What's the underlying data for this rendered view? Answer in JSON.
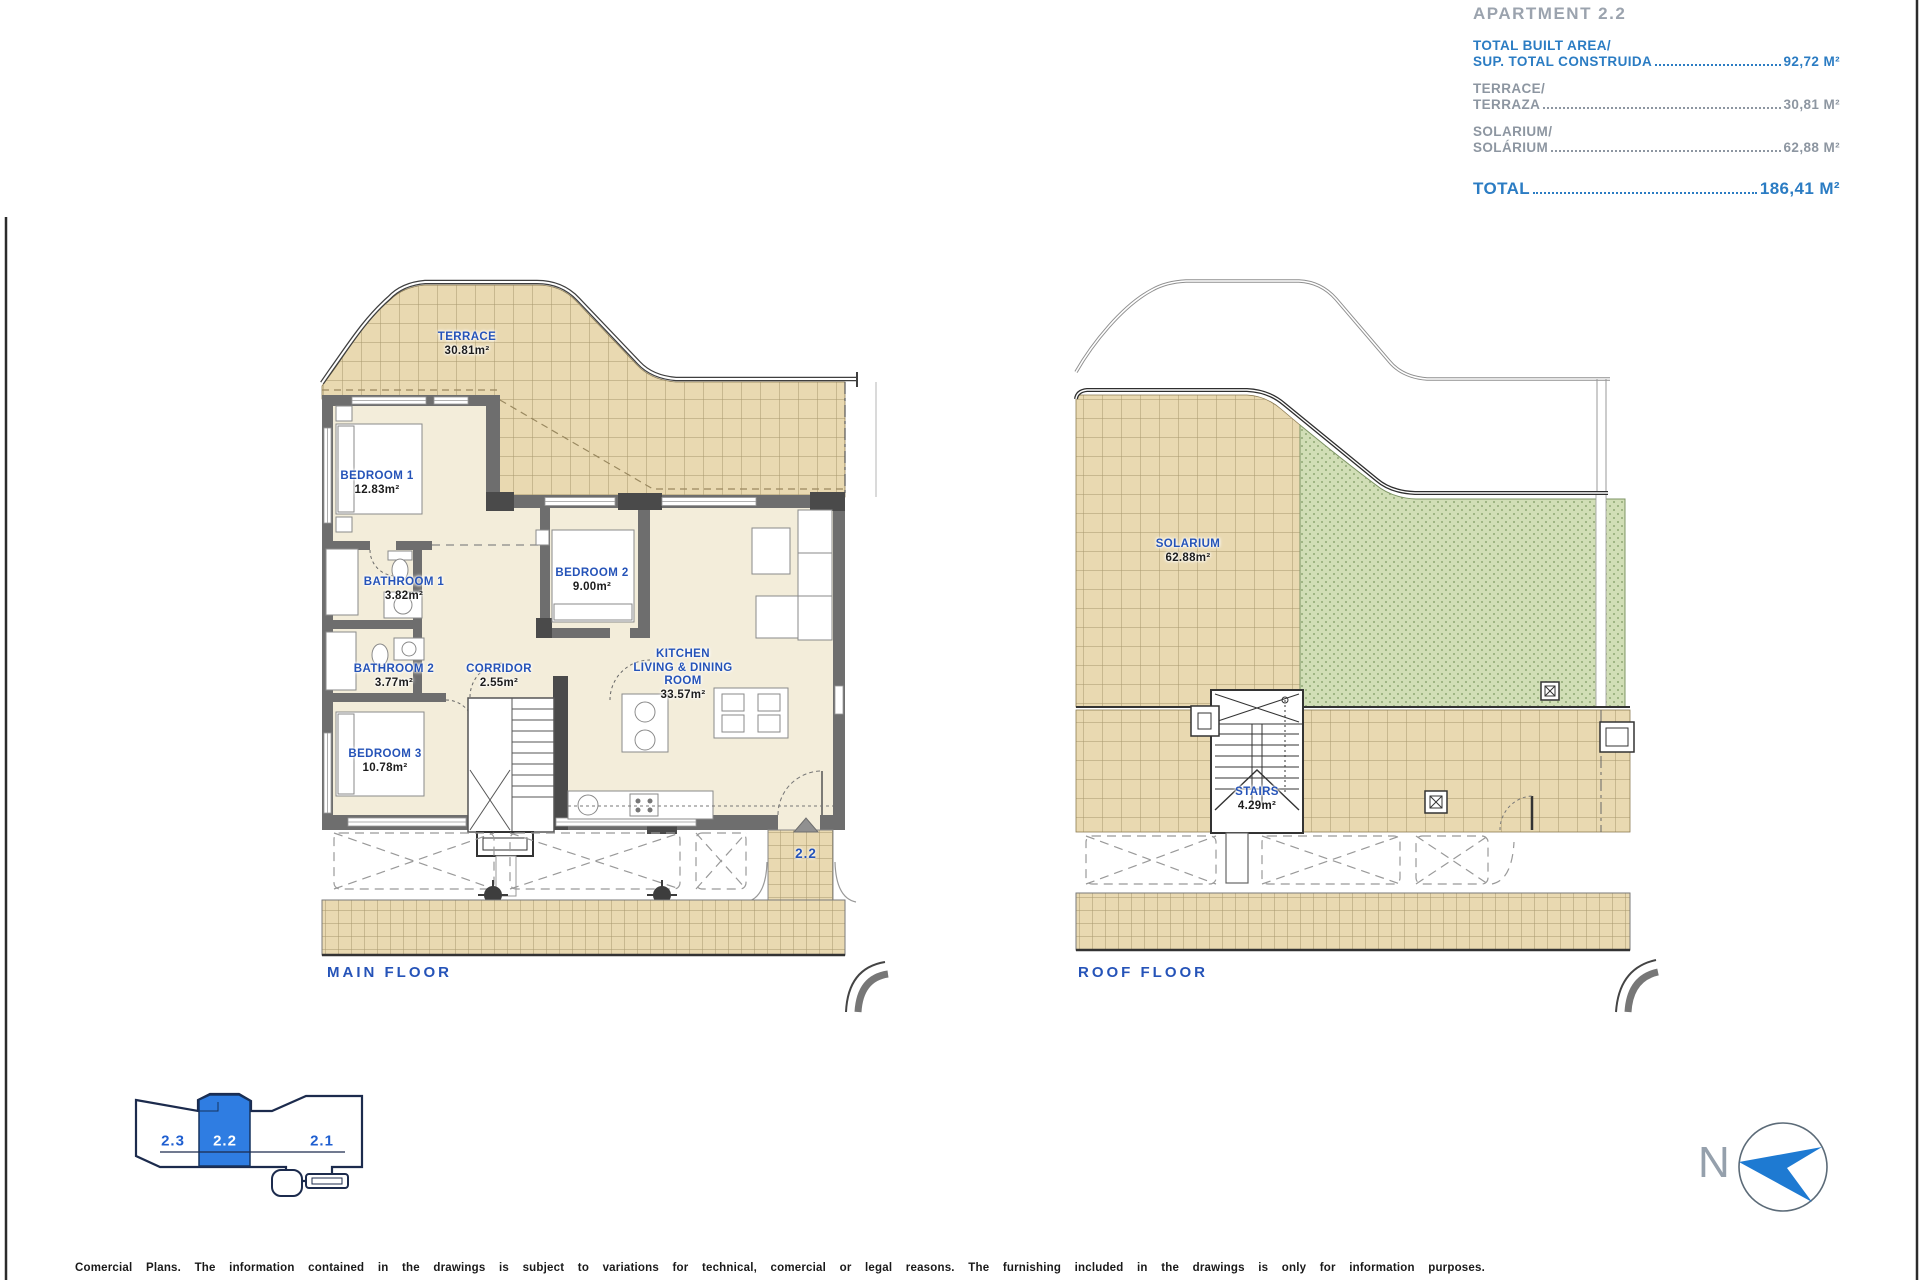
{
  "title_block": {
    "apartment_label": "APARTMENT 2.2",
    "rows": [
      {
        "label_line1": "TOTAL BUILT AREA/",
        "label_line2": "SUP. TOTAL CONSTRUIDA",
        "value": "92,72 M²",
        "emphasis": true
      },
      {
        "label_line1": "TERRACE/",
        "label_line2": "TERRAZA",
        "value": "30,81 M²",
        "emphasis": false
      },
      {
        "label_line1": "SOLARIUM/",
        "label_line2": "SOLÁRIUM",
        "value": "62,88 M²",
        "emphasis": false
      }
    ],
    "total_label": "TOTAL",
    "total_value": "186,41 M²"
  },
  "main_floor": {
    "caption": "MAIN FLOOR",
    "entrance_label": "2.2",
    "rooms": [
      {
        "name": "TERRACE",
        "area": "30.81m²"
      },
      {
        "name": "BEDROOM 1",
        "area": "12.83m²"
      },
      {
        "name": "BATHROOM 1",
        "area": "3.82m²"
      },
      {
        "name": "BATHROOM 2",
        "area": "3.77m²"
      },
      {
        "name": "CORRIDOR",
        "area": "2.55m²"
      },
      {
        "name": "BEDROOM 3",
        "area": "10.78m²"
      },
      {
        "name": "BEDROOM 2",
        "area": "9.00m²"
      },
      {
        "name_line1": "KITCHEN",
        "name_line2": "LIVING & DINING",
        "name_line3": "ROOM",
        "area": "33.57m²"
      }
    ]
  },
  "roof_floor": {
    "caption": "ROOF FLOOR",
    "rooms": [
      {
        "name": "SOLARIUM",
        "area": "62.88m²"
      },
      {
        "name": "STAIRS",
        "area": "4.29m²"
      }
    ]
  },
  "key_plan": {
    "units": [
      {
        "label": "2.3",
        "highlighted": false
      },
      {
        "label": "2.2",
        "highlighted": true
      },
      {
        "label": "2.1",
        "highlighted": false
      }
    ]
  },
  "compass": {
    "north_label": "N"
  },
  "footer": {
    "disclaimer": "Comercial Plans. The information contained in the drawings is subject to variations for technical, comercial or legal reasons. The furnishing included in the drawings is only for information purposes."
  },
  "colors": {
    "accent_blue": "#2b7cc3",
    "label_blue": "#2553b8",
    "gray_text": "#8d96a1",
    "tile_fill": "#e9d9b1",
    "tile_line": "#a8976d",
    "green_fill": "#d1deb6",
    "wall_gray": "#6e6e6e",
    "room_fill": "#f3edda",
    "key_unit_blue": "#2f7de2",
    "compass_blue": "#1e7ad2"
  }
}
